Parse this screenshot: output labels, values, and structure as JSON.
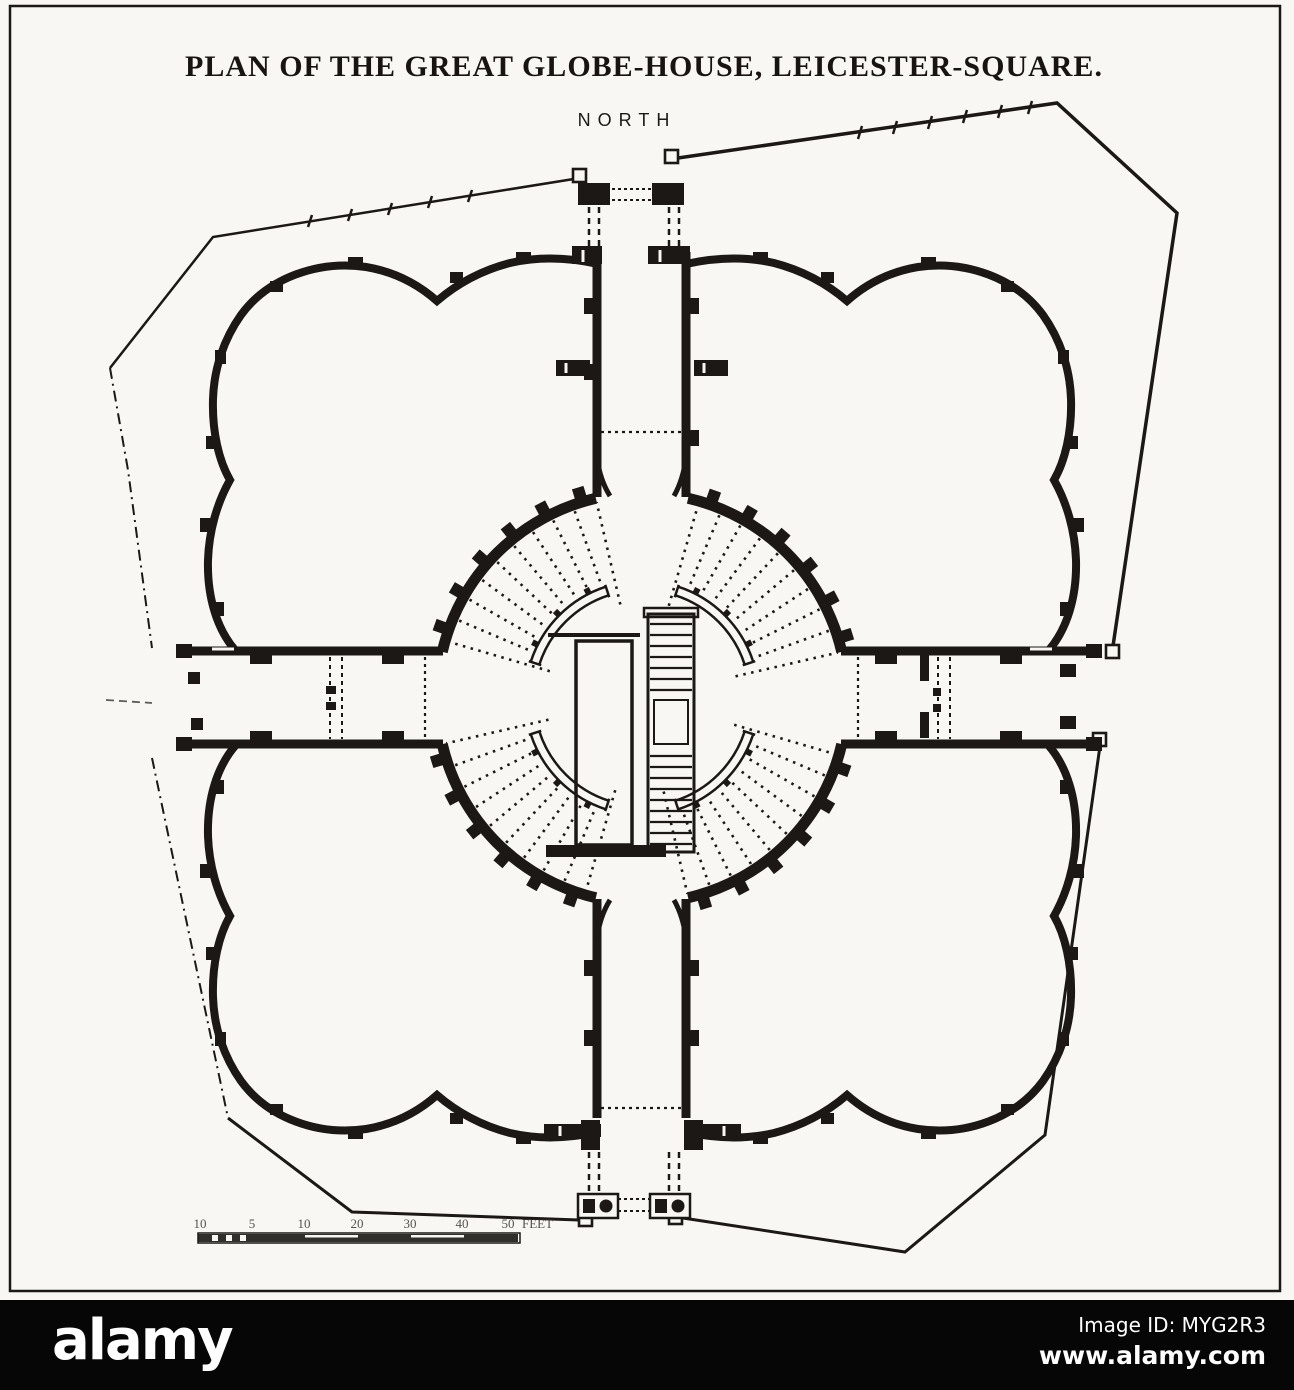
{
  "title": "PLAN OF THE GREAT GLOBE-HOUSE, LEICESTER-SQUARE.",
  "compass": {
    "north_label": "NORTH"
  },
  "scale_bar": {
    "ticks": [
      "10",
      "5",
      "10",
      "20",
      "30",
      "40",
      "50"
    ],
    "unit": "FEET"
  },
  "watermark": {
    "logo": "alamy",
    "image_id_label": "Image ID: MYG2R3",
    "url": "www.alamy.com"
  },
  "colors": {
    "ink": "#1b1815",
    "paper": "#f8f7f3",
    "bar_background": "#060606",
    "bar_text": "#ffffff"
  }
}
